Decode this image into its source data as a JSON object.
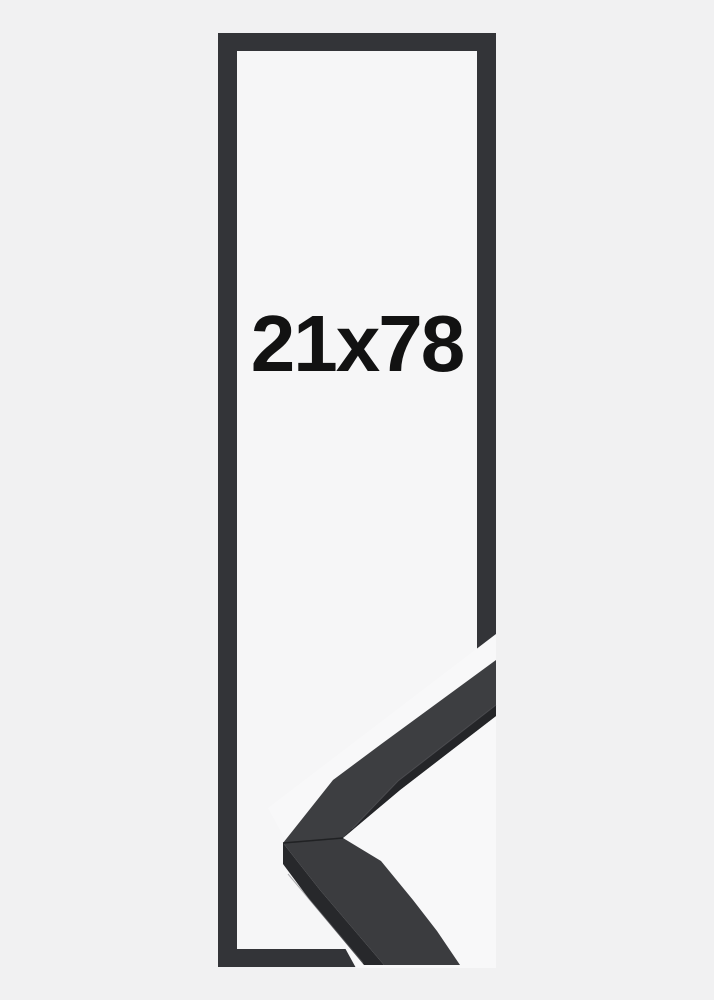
{
  "product": {
    "size_label": "21x78",
    "frame_style": "black-frame-outline-with-corner-sample"
  },
  "colors": {
    "page_background": "#f1f1f2",
    "inner_background": "#f6f6f7",
    "photo_background": "#f8f8f9",
    "frame_outline": "#333438",
    "label_text": "#121212",
    "moulding_top_surface_upper_arm": "#3d3e41",
    "moulding_top_surface_lower_arm": "#3b3c3f",
    "moulding_inner_face": "#242528",
    "moulding_outer_face": "#27282b",
    "miter_seam": "#1c1d1f",
    "arris_highlight": "#55565a",
    "silhouette_highlight": "#6f7073"
  }
}
